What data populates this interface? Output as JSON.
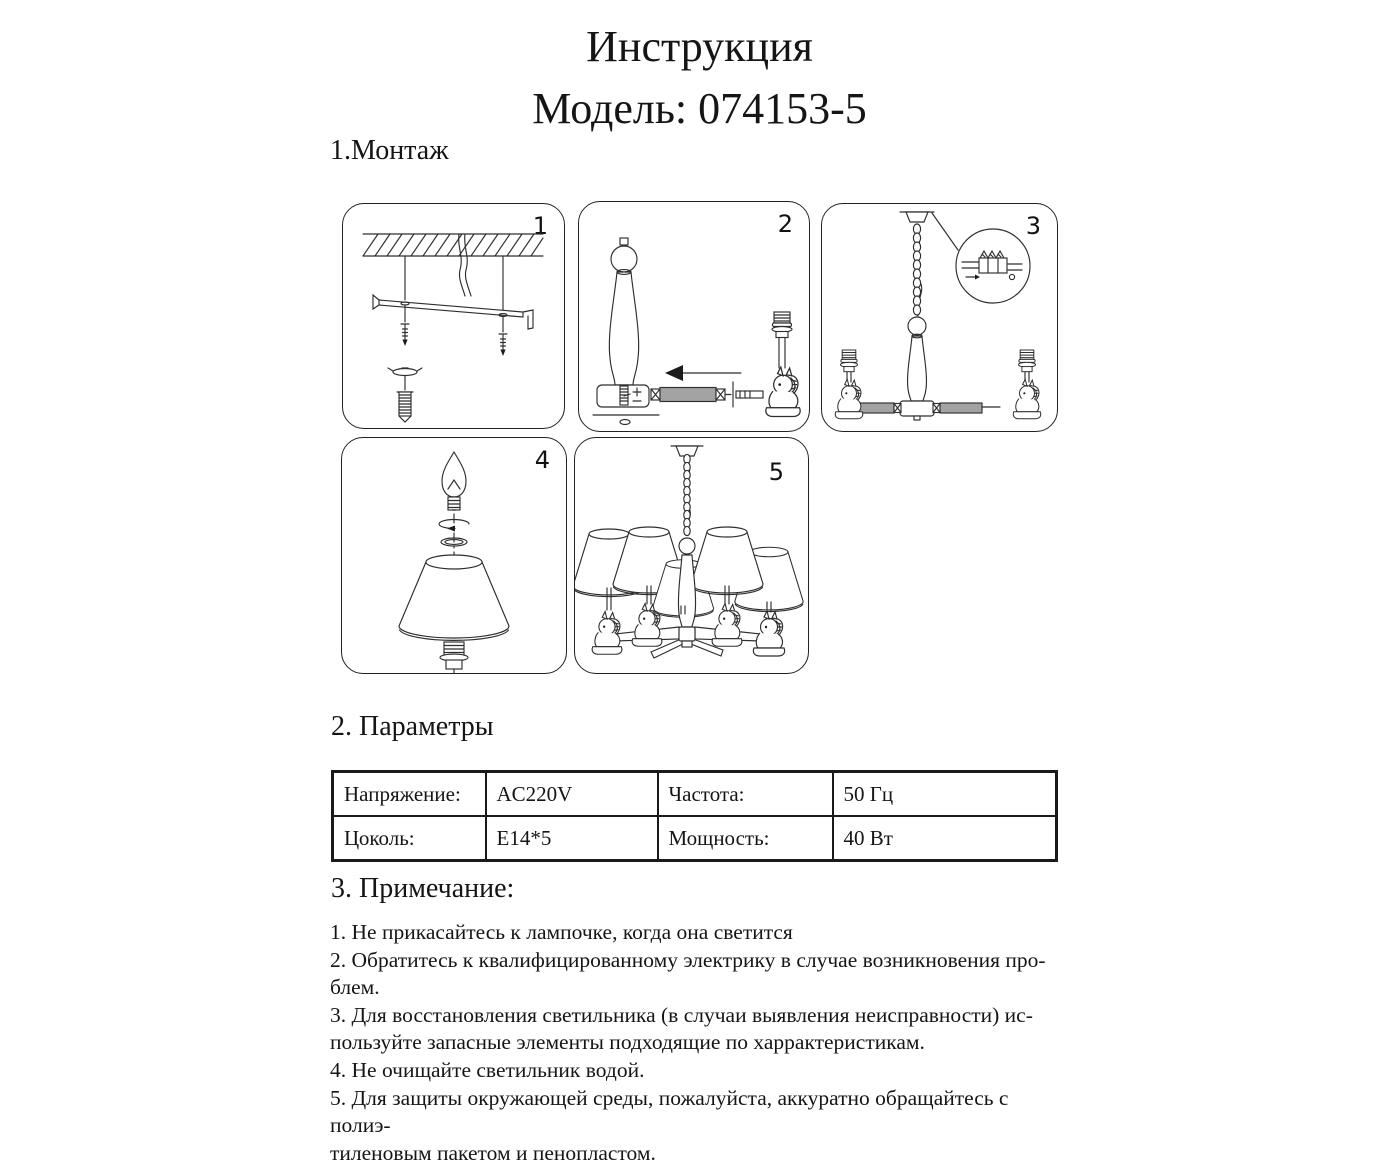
{
  "page_title": {
    "line1": "Инструкция",
    "line2": "Модель: 074153-5"
  },
  "montage": {
    "heading": "1.Монтаж",
    "steps": [
      "1",
      "2",
      "3",
      "4",
      "5"
    ]
  },
  "parameters": {
    "heading": "2. Параметры",
    "table": {
      "rows": [
        [
          "Напряжение:",
          "AC220V",
          "Частота:",
          "50 Гц"
        ],
        [
          "Цоколь:",
          "E14*5",
          "Мощность:",
          "40 Вт"
        ]
      ]
    }
  },
  "notes": {
    "heading": "3. Примечание:",
    "items": [
      "1. Не прикасайтесь к лампочке, когда она светится",
      "2. Обратитесь к квалифицированному электрику в случае возникновения про-\nблем.",
      "3. Для восстановления светильника (в случаи выявления неисправности) ис-\nпользуйте запасные элементы подходящие по харрактеристикам.",
      "4. Не очищайте  светильник водой.",
      "5. Для защиты окружающей среды, пожалуйста, аккуратно обращайтесь с полиэ-\nтиленовым пакетом и пенопластом."
    ]
  },
  "colors": {
    "line_art": "#2e2e2e",
    "tube_gray": "#a3a3a3",
    "table_border": "#1a1a1a",
    "text": "#151515",
    "background": "#ffffff"
  }
}
